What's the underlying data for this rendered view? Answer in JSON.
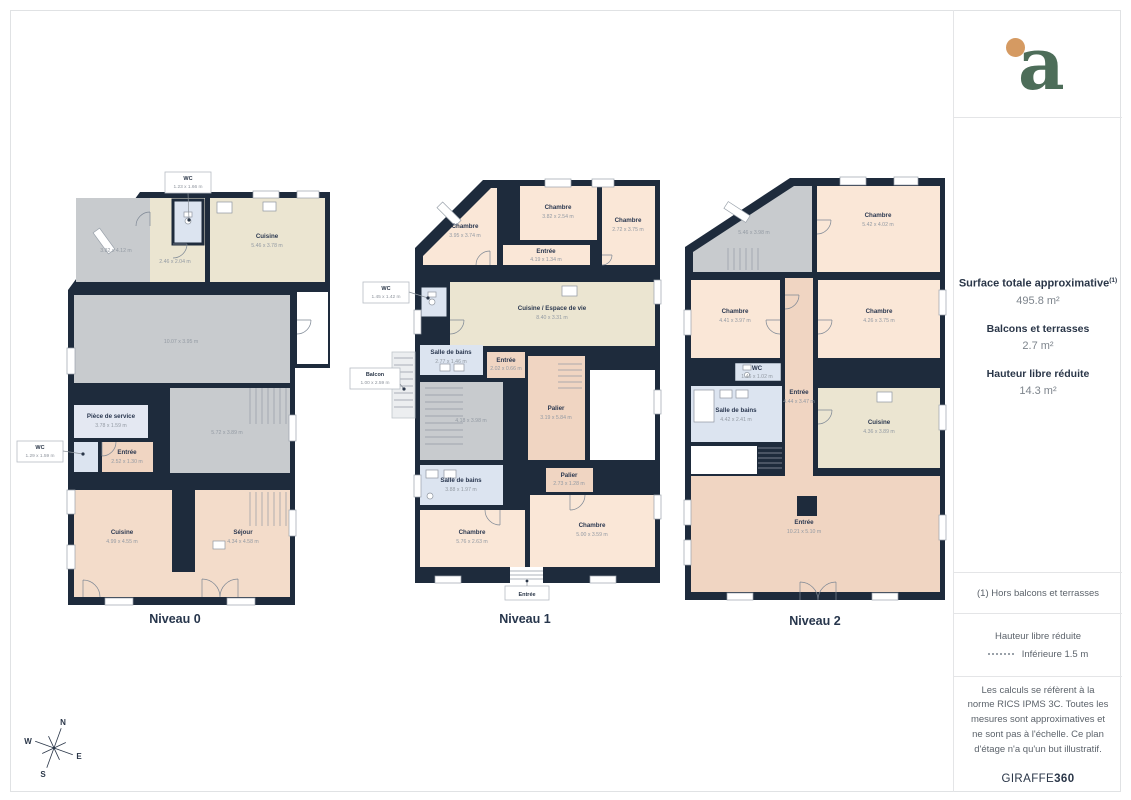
{
  "sidebar": {
    "logo_letter": "a",
    "surface": {
      "title": "Surface totale approximative",
      "title_sup": "(1)",
      "total_value": "495.8 m²",
      "balconies_label": "Balcons et terrasses",
      "balconies_value": "2.7 m²",
      "reduced_label": "Hauteur libre réduite",
      "reduced_value": "14.3 m²"
    },
    "footnote": "(1) Hors balcons et terrasses",
    "legend": {
      "title": "Hauteur libre réduite",
      "item": "Inférieure 1.5 m"
    },
    "disclaimer": "Les calculs se réfèrent à la norme RICS IPMS 3C. Toutes les mesures sont approximatives et ne sont pas à l'échelle. Ce plan d'étage n'a qu'un but illustratif.",
    "brand_name": "GIRAFFE",
    "brand_suffix": "360"
  },
  "compass": {
    "north": "N",
    "south": "S",
    "east": "E",
    "west": "W"
  },
  "floors": {
    "level0": {
      "label": "Niveau 0",
      "callouts": {
        "wc_top": {
          "name": "WC",
          "dims": "1.23 x 1.66 m"
        },
        "wc_left": {
          "name": "WC",
          "dims": "1.29 x 1.59 m"
        }
      },
      "rooms": {
        "diagonale": {
          "dims": "3.82 x 4.12 m"
        },
        "couloir": {
          "dims": "2.46 x 2.04 m"
        },
        "cuisine_haut": {
          "name": "Cuisine",
          "dims": "5.46 x 3.78 m"
        },
        "grande_piece": {
          "dims": "10.07 x 3.95 m"
        },
        "piece_service": {
          "name": "Pièce de service",
          "dims": "3.78 x 1.59 m"
        },
        "piece_572": {
          "dims": "5.72 x 3.89 m"
        },
        "entree": {
          "name": "Entrée",
          "dims": "2.52 x 1.30 m"
        },
        "cuisine_bas": {
          "name": "Cuisine",
          "dims": "4.99 x 4.55 m"
        },
        "sejour": {
          "name": "Séjour",
          "dims": "4.34 x 4.58 m"
        }
      }
    },
    "level1": {
      "label": "Niveau 1",
      "callouts": {
        "wc": {
          "name": "WC",
          "dims": "1.45 x 1.42 m"
        },
        "balcon": {
          "name": "Balcon",
          "dims": "1.00 x 2.59 m"
        },
        "entree_bas": {
          "name": "Entrée"
        }
      },
      "rooms": {
        "chambre_ho": {
          "name": "Chambre",
          "dims": "3.95 x 3.74 m"
        },
        "chambre_hc": {
          "name": "Chambre",
          "dims": "3.82 x 2.54 m"
        },
        "chambre_hd": {
          "name": "Chambre",
          "dims": "2.72 x 3.75 m"
        },
        "entree_haut": {
          "name": "Entrée",
          "dims": "4.19 x 1.34 m"
        },
        "cuisine": {
          "name": "Cuisine / Espace de vie",
          "dims": "8.40 x 3.31 m"
        },
        "salle_bains_1": {
          "name": "Salle de bains",
          "dims": "2.77 x 1.46 m"
        },
        "entree_petite": {
          "name": "Entrée",
          "dims": "2.02 x 0.66 m"
        },
        "escalier": {
          "dims": "4.18 x 3.98 m"
        },
        "palier_1": {
          "name": "Palier",
          "dims": "3.19 x 5.84 m"
        },
        "salle_bains_2": {
          "name": "Salle de bains",
          "dims": "3.88 x 1.97 m"
        },
        "palier_2": {
          "name": "Palier",
          "dims": "2.73 x 1.28 m"
        },
        "chambre_bo": {
          "name": "Chambre",
          "dims": "5.76 x 2.63 m"
        },
        "chambre_bd": {
          "name": "Chambre",
          "dims": "5.00 x 3.59 m"
        }
      }
    },
    "level2": {
      "label": "Niveau 2",
      "rooms": {
        "diagonale": {
          "dims": "5.46 x 3.98 m"
        },
        "chambre_hd": {
          "name": "Chambre",
          "dims": "5.42 x 4.02 m"
        },
        "chambre_mo": {
          "name": "Chambre",
          "dims": "4.41 x 3.97 m"
        },
        "chambre_md": {
          "name": "Chambre",
          "dims": "4.26 x 3.75 m"
        },
        "wc": {
          "name": "WC",
          "dims": "1.46 x 1.02 m"
        },
        "salle_bains": {
          "name": "Salle de bains",
          "dims": "4.42 x 2.41 m"
        },
        "entree_v": {
          "name": "Entrée",
          "dims": "4.44 x 3.47 m"
        },
        "cuisine": {
          "name": "Cuisine",
          "dims": "4.36 x 3.89 m"
        },
        "entree_bas": {
          "name": "Entrée",
          "dims": "10.21 x 5.10 m"
        }
      }
    }
  },
  "colors": {
    "wall": "#1e2b3c",
    "pink": "#fae7d7",
    "salmon": "#f0d5c2",
    "cream": "#ebe5d1",
    "gray": "#c8cbce",
    "blue": "#dce4f0",
    "logo_green": "#4d6d59",
    "logo_orange": "#d59a62"
  }
}
